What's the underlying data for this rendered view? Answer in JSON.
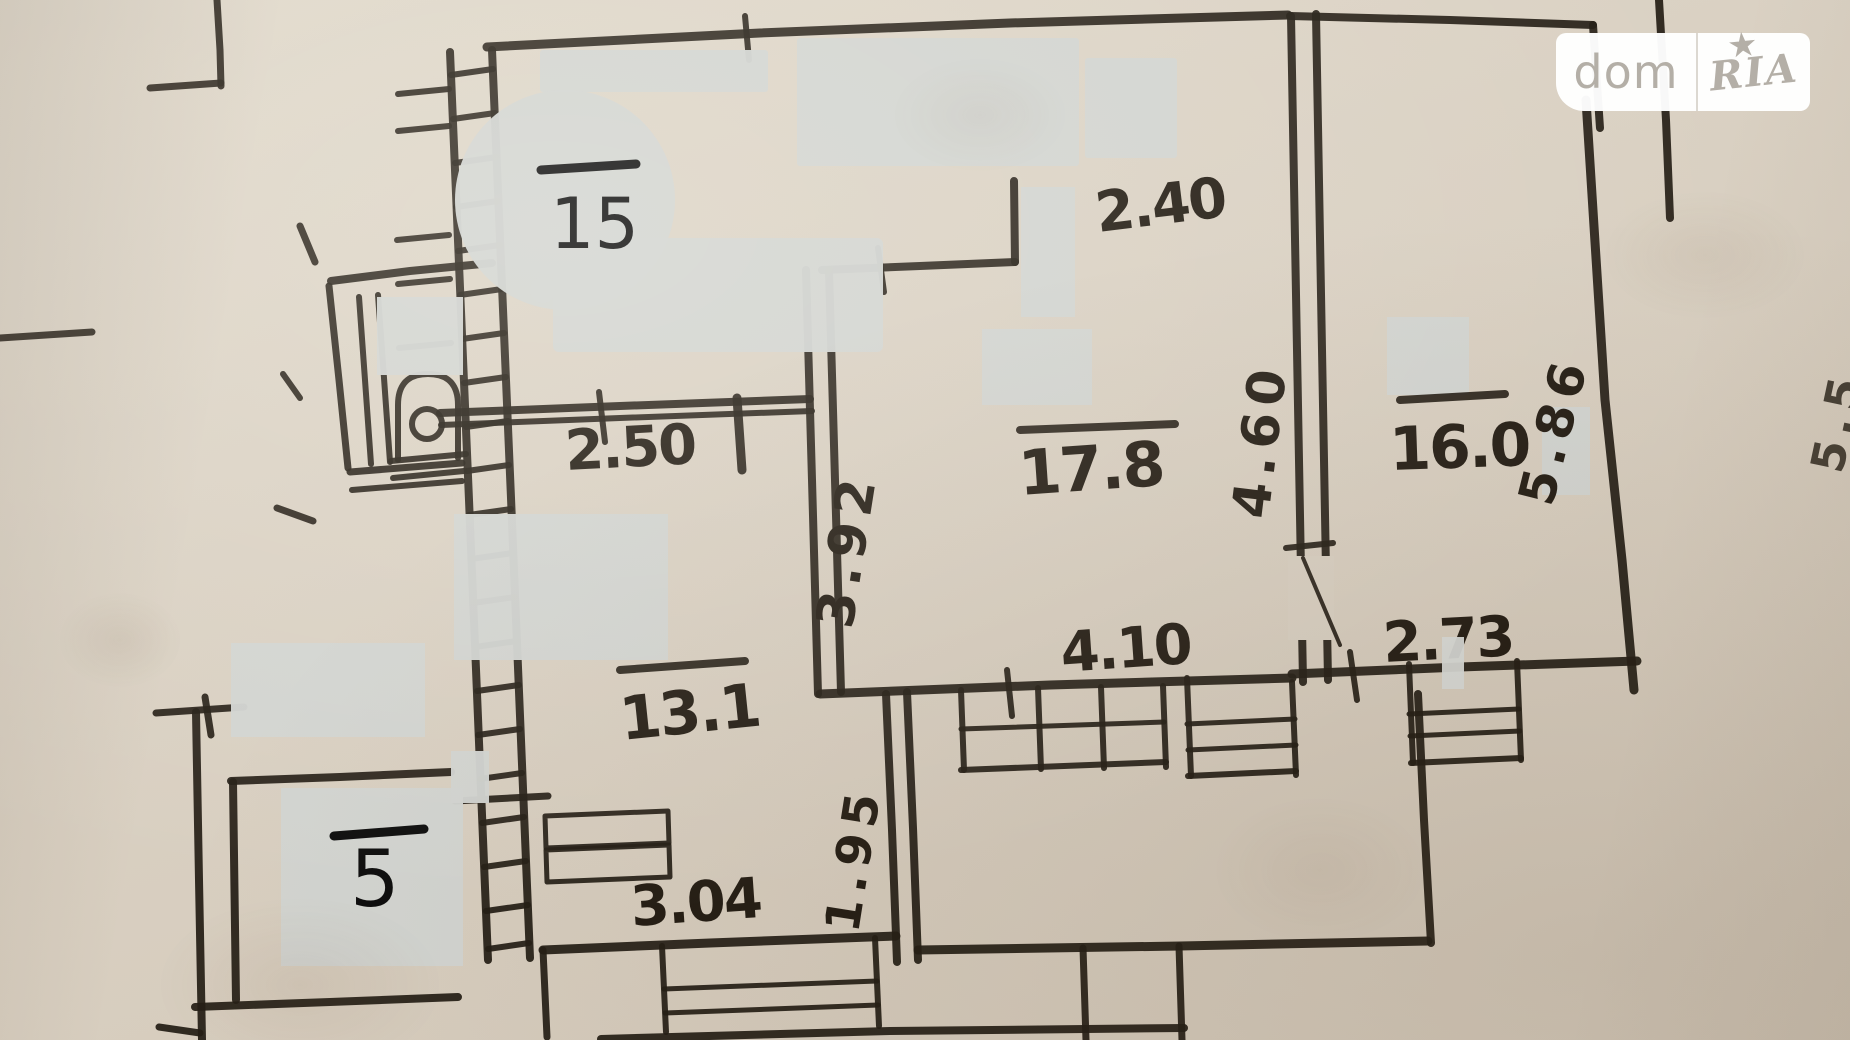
{
  "watermark": {
    "left": "dom",
    "right": "RIA",
    "star": "★"
  },
  "plan": {
    "room_numbers": {
      "r15": "15",
      "r5": "5"
    },
    "areas": {
      "a178": "17.8",
      "a160": "16.0",
      "a131": "13.1"
    },
    "dims": {
      "d250": "2.50",
      "d240": "2.40",
      "d460": "4.60",
      "d586": "5.86",
      "d392": "3.92",
      "d410": "4.10",
      "d273": "2.73",
      "d195": "1.95",
      "d304": "3.04",
      "d55": "5.5"
    },
    "colors": {
      "paper": "#d9d0c2",
      "ink": "#241d14",
      "redaction": "#d2d4d1",
      "logo_text": "#b4afa7"
    }
  }
}
